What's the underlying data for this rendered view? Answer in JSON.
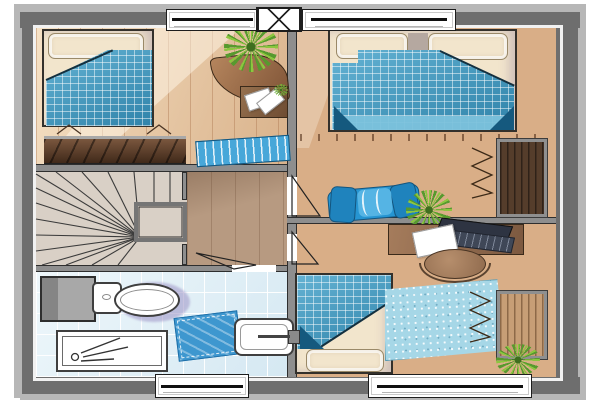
{
  "palette": {
    "eave": "#b7b7b7",
    "wall": "#6e6e6e",
    "wall_in": "#8e8e8e",
    "edge": "#2e2e2e",
    "wood1": "#ecd2b4",
    "wood2": "#d9ae87",
    "landing": "#b79a81",
    "stairs": "#d9d0c6",
    "tile": "#dcedf5",
    "blanket": "#3d9fc8",
    "blanket_dark": "#15597e",
    "sheet": "#7cc2dc",
    "lounge": "#2695d2",
    "rug": "#a6d7e7",
    "mat": "#47a7d9",
    "bathmat": "#3e97cf",
    "cream": "#f2e5cc",
    "wood_dark": "#553d2b",
    "wood_mid": "#916c4f",
    "wardrobe_lt": "#c79e76",
    "green": "#579a2e",
    "green_lt": "#8cc63f",
    "purple": "#9d93c6",
    "fixture": "#9e9e9e",
    "laptop": "#2e3442",
    "laptop_key": "#9aa3b8"
  },
  "plan": {
    "type": "floor-plan",
    "rooms": [
      {
        "name": "bedroom-top-left",
        "furniture": [
          "bed",
          "corner-desk",
          "potted-plant",
          "side-table",
          "papers",
          "sideboard-wardrobe",
          "striped-door-mat"
        ]
      },
      {
        "name": "bedroom-top-right",
        "furniture": [
          "double-bed",
          "built-in-wardrobe",
          "folded-blue-lounger",
          "potted-plant"
        ]
      },
      {
        "name": "hall-landing",
        "furniture": [
          "winder-staircase",
          "stair-landing",
          "railing"
        ]
      },
      {
        "name": "bathroom",
        "furniture": [
          "toilet",
          "shower-tray",
          "washbasin-with-faucet",
          "bath-mat",
          "service-duct"
        ]
      },
      {
        "name": "bedroom-bottom-right",
        "furniture": [
          "desk",
          "laptop",
          "paper-sheet",
          "round-chair",
          "single-bed",
          "area-rug",
          "built-in-wardrobe",
          "potted-plant"
        ]
      }
    ],
    "openings": {
      "top_windows": 2,
      "bottom_windows": 2,
      "chimney_boxes": 1,
      "interior_doors": 3
    }
  }
}
